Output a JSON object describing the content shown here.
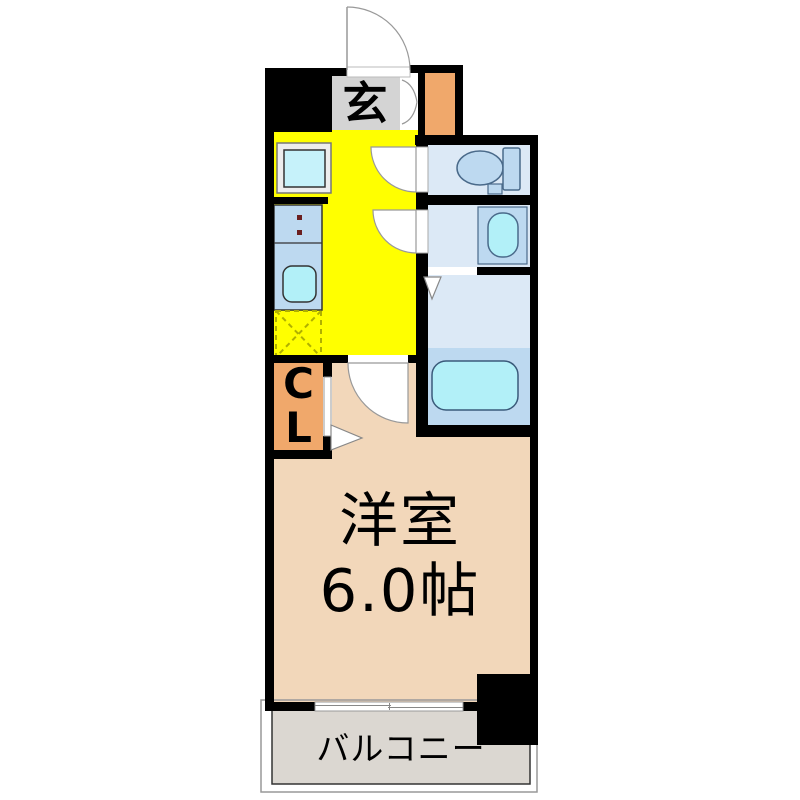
{
  "floorplan": {
    "rooms": {
      "entrance": {
        "name": "genkan",
        "label": "玄"
      },
      "kitchen": {
        "name": "kitchen-hallway",
        "label": ""
      },
      "toilet": {
        "name": "toilet-room",
        "label": ""
      },
      "washroom": {
        "name": "washroom",
        "label": ""
      },
      "bathroom": {
        "name": "bathroom",
        "label": ""
      },
      "closet": {
        "name": "closet",
        "label_line1": "C",
        "label_line2": "L"
      },
      "western_room": {
        "name": "western-room",
        "label_line1": "洋室",
        "label_line2": "6.0帖",
        "size_tatami": "6.0"
      },
      "balcony": {
        "name": "balcony",
        "label": "バルコニー"
      }
    },
    "fixtures": [
      "entrance-door",
      "shoe-storage-doors",
      "refrigerator-space",
      "kitchen-counter",
      "stove-burners",
      "kitchen-sink",
      "washer-space",
      "toilet",
      "wash-basin",
      "bathtub",
      "room-window"
    ],
    "colors": {
      "wall": "#000000",
      "entrance_floor": "#d4d4d4",
      "kitchen_floor": "#ffff00",
      "closet_fill": "#f0a86b",
      "service_block_fill": "#f0a86b",
      "room_floor": "#f2d7ba",
      "wet_room_floor": "#dce9f6",
      "fixture_fill": "#bdd9f0",
      "water_fill": "#b2f0f8",
      "balcony_floor": "#dbd7d1",
      "outline": "#999999"
    }
  }
}
